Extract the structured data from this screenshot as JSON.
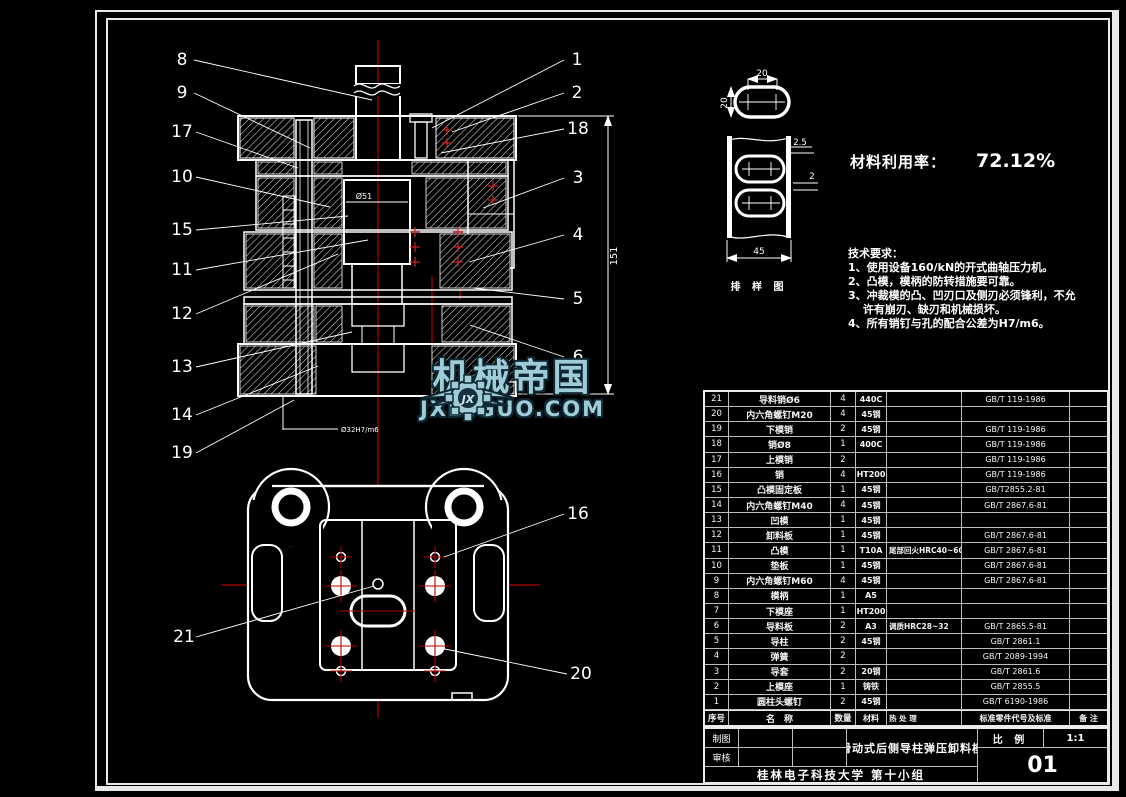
{
  "colors": {
    "background": "#000000",
    "line": "#ffffff",
    "centerline": "#b40000",
    "watermark": "#9fccd6",
    "table_grid": "#bdbdbd"
  },
  "material_rate": {
    "label": "材料利用率：",
    "value": "72.12%"
  },
  "tech": {
    "lines": [
      "技术要求：",
      "1、使用设备160/kN的开式曲轴压力机。",
      "2、凸模，模柄的防转措施要可靠。",
      "3、冲裁模的凸、凹刃口及侧刃必须锋利，不允",
      "　 许有崩刃、缺刃和机械损坏。",
      "4、所有销钉与孔的配合公差为H7/m6。"
    ]
  },
  "strip": {
    "dim_top": "20",
    "dim_left": "20",
    "dim_pitch": "2.5",
    "dim_web": "2",
    "dim_width": "45",
    "caption": "排 样 图"
  },
  "section_dims": {
    "height": "151",
    "punch": "Ø51",
    "fit": "Ø32H7/m6"
  },
  "callouts": [
    {
      "n": "8",
      "tx": 182,
      "ty": 65,
      "x1": 194,
      "y1": 60,
      "x2": 372,
      "y2": 100
    },
    {
      "n": "9",
      "tx": 182,
      "ty": 98,
      "x1": 194,
      "y1": 93,
      "x2": 310,
      "y2": 148
    },
    {
      "n": "17",
      "tx": 182,
      "ty": 137,
      "x1": 196,
      "y1": 132,
      "x2": 298,
      "y2": 168
    },
    {
      "n": "10",
      "tx": 182,
      "ty": 182,
      "x1": 196,
      "y1": 177,
      "x2": 330,
      "y2": 207
    },
    {
      "n": "15",
      "tx": 182,
      "ty": 235,
      "x1": 196,
      "y1": 230,
      "x2": 348,
      "y2": 216
    },
    {
      "n": "11",
      "tx": 182,
      "ty": 275,
      "x1": 196,
      "y1": 270,
      "x2": 368,
      "y2": 240
    },
    {
      "n": "12",
      "tx": 182,
      "ty": 319,
      "x1": 196,
      "y1": 314,
      "x2": 338,
      "y2": 254
    },
    {
      "n": "13",
      "tx": 182,
      "ty": 372,
      "x1": 196,
      "y1": 367,
      "x2": 352,
      "y2": 332
    },
    {
      "n": "14",
      "tx": 182,
      "ty": 420,
      "x1": 196,
      "y1": 415,
      "x2": 318,
      "y2": 366
    },
    {
      "n": "19",
      "tx": 182,
      "ty": 458,
      "x1": 196,
      "y1": 453,
      "x2": 294,
      "y2": 400
    },
    {
      "n": "1",
      "tx": 577,
      "ty": 65,
      "x1": 564,
      "y1": 60,
      "x2": 432,
      "y2": 128
    },
    {
      "n": "2",
      "tx": 577,
      "ty": 98,
      "x1": 564,
      "y1": 93,
      "x2": 452,
      "y2": 132
    },
    {
      "n": "18",
      "tx": 578,
      "ty": 134,
      "x1": 564,
      "y1": 129,
      "x2": 441,
      "y2": 153
    },
    {
      "n": "3",
      "tx": 578,
      "ty": 183,
      "x1": 564,
      "y1": 178,
      "x2": 483,
      "y2": 208
    },
    {
      "n": "4",
      "tx": 578,
      "ty": 240,
      "x1": 564,
      "y1": 235,
      "x2": 469,
      "y2": 262
    },
    {
      "n": "5",
      "tx": 578,
      "ty": 304,
      "x1": 564,
      "y1": 299,
      "x2": 473,
      "y2": 288
    },
    {
      "n": "6",
      "tx": 578,
      "ty": 362,
      "x1": 564,
      "y1": 357,
      "x2": 470,
      "y2": 325
    },
    {
      "n": "16",
      "tx": 578,
      "ty": 519,
      "x1": 564,
      "y1": 514,
      "x2": 444,
      "y2": 557
    },
    {
      "n": "21",
      "tx": 184,
      "ty": 642,
      "x1": 196,
      "y1": 637,
      "x2": 374,
      "y2": 586
    },
    {
      "n": "20",
      "tx": 581,
      "ty": 679,
      "x1": 567,
      "y1": 674,
      "x2": 440,
      "y2": 648
    }
  ],
  "bom": {
    "headers": [
      "序号",
      "名　称",
      "数量",
      "材料",
      "热 处 理",
      "标准零件代号及标准",
      "备 注"
    ],
    "rows": [
      [
        "21",
        "导料销Ø6",
        "4",
        "440C",
        "",
        "GB/T 119-1986",
        ""
      ],
      [
        "20",
        "内六角螺钉M20",
        "4",
        "45钢",
        "",
        "",
        ""
      ],
      [
        "19",
        "下模销",
        "2",
        "45钢",
        "",
        "GB/T 119-1986",
        ""
      ],
      [
        "18",
        "销Ø8",
        "1",
        "400C",
        "",
        "GB/T 119-1986",
        ""
      ],
      [
        "17",
        "上模销",
        "2",
        "",
        "",
        "GB/T 119-1986",
        ""
      ],
      [
        "16",
        "销",
        "4",
        "HT200",
        "",
        "GB/T 119-1986",
        ""
      ],
      [
        "15",
        "凸模固定板",
        "1",
        "45钢",
        "",
        "GB/T2855.2-81",
        ""
      ],
      [
        "14",
        "内六角螺钉M40",
        "4",
        "45钢",
        "",
        "GB/T 2867.6-81",
        ""
      ],
      [
        "13",
        "凹模",
        "1",
        "45钢",
        "",
        "",
        ""
      ],
      [
        "12",
        "卸料板",
        "1",
        "45钢",
        "",
        "GB/T 2867.6-81",
        ""
      ],
      [
        "11",
        "凸模",
        "1",
        "T10A",
        "尾部回火HRC40~60",
        "GB/T 2867.6-81",
        ""
      ],
      [
        "10",
        "垫板",
        "1",
        "45钢",
        "",
        "GB/T 2867.6-81",
        ""
      ],
      [
        "9",
        "内六角螺钉M60",
        "4",
        "45钢",
        "",
        "GB/T 2867.6-81",
        ""
      ],
      [
        "8",
        "模柄",
        "1",
        "A5",
        "",
        "",
        ""
      ],
      [
        "7",
        "下模座",
        "1",
        "HT200",
        "",
        "",
        ""
      ],
      [
        "6",
        "导料板",
        "2",
        "A3",
        "调质HRC28~32",
        "GB/T 2865.5-81",
        ""
      ],
      [
        "5",
        "导柱",
        "2",
        "45钢",
        "",
        "GB/T 2861.1",
        ""
      ],
      [
        "4",
        "弹簧",
        "2",
        "",
        "",
        "GB/T 2089-1994",
        ""
      ],
      [
        "3",
        "导套",
        "2",
        "20钢",
        "",
        "GB/T 2861.6",
        ""
      ],
      [
        "2",
        "上模座",
        "1",
        "铸铁",
        "",
        "GB/T 2855.5",
        ""
      ],
      [
        "1",
        "圆柱头螺钉",
        "2",
        "45钢",
        "",
        "GB/T 6190-1986",
        ""
      ]
    ]
  },
  "titleblock": {
    "draw_label": "制图",
    "check_label": "审核",
    "title": "滑动式后侧导柱弹压卸料模",
    "scale_label": "比 例",
    "scale": "1:1",
    "sheet": "01",
    "org": "桂林电子科技大学 第十小组"
  },
  "watermark": {
    "brand": "机械帝国",
    "url": "JXDIGUO.COM",
    "monogram": "JX"
  }
}
